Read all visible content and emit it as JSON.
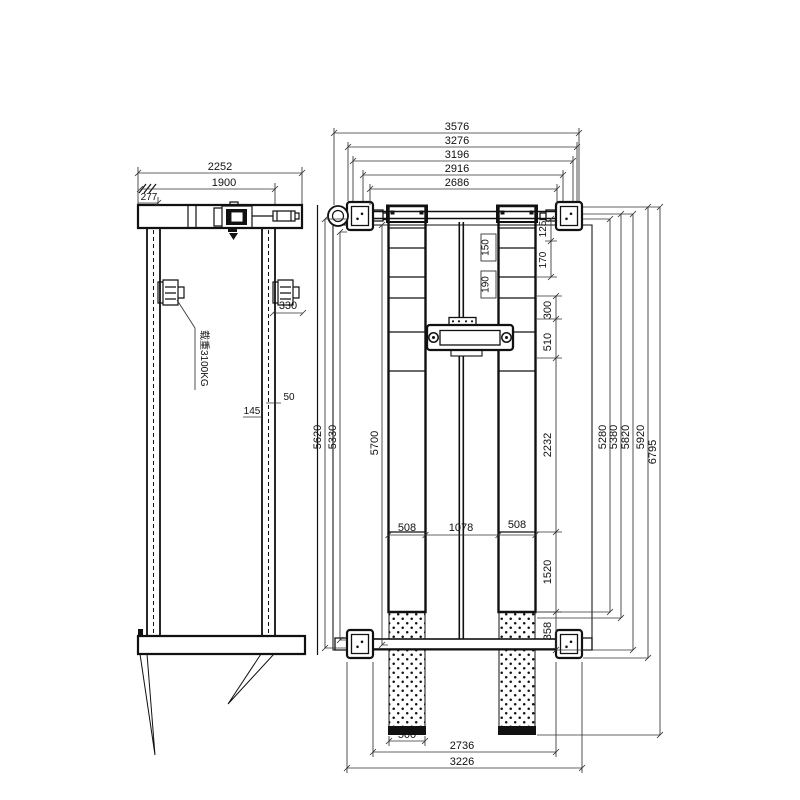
{
  "colors": {
    "ink": "#111111",
    "dim_line": "#333333",
    "paper": "#ffffff"
  },
  "side_view": {
    "overall_width": "2252",
    "column_spacing": "1900",
    "end_offset": "277",
    "motor_offset": "330",
    "detail_50": "50",
    "detail_145": "145",
    "capacity_label": "载重3100KG"
  },
  "plan_view": {
    "top": [
      "3576",
      "3276",
      "3196",
      "2916",
      "2686"
    ],
    "runway": [
      "508",
      "1078",
      "508"
    ],
    "right_steps": [
      "125",
      "150",
      "170",
      "190",
      "300",
      "510",
      "2232",
      "1520",
      "358"
    ],
    "left_lengths": [
      "5620",
      "5330",
      "5700"
    ],
    "right_lengths": [
      "5280",
      "5380",
      "5820",
      "5920",
      "6795"
    ],
    "bottom": [
      "500",
      "2736",
      "3226"
    ]
  }
}
